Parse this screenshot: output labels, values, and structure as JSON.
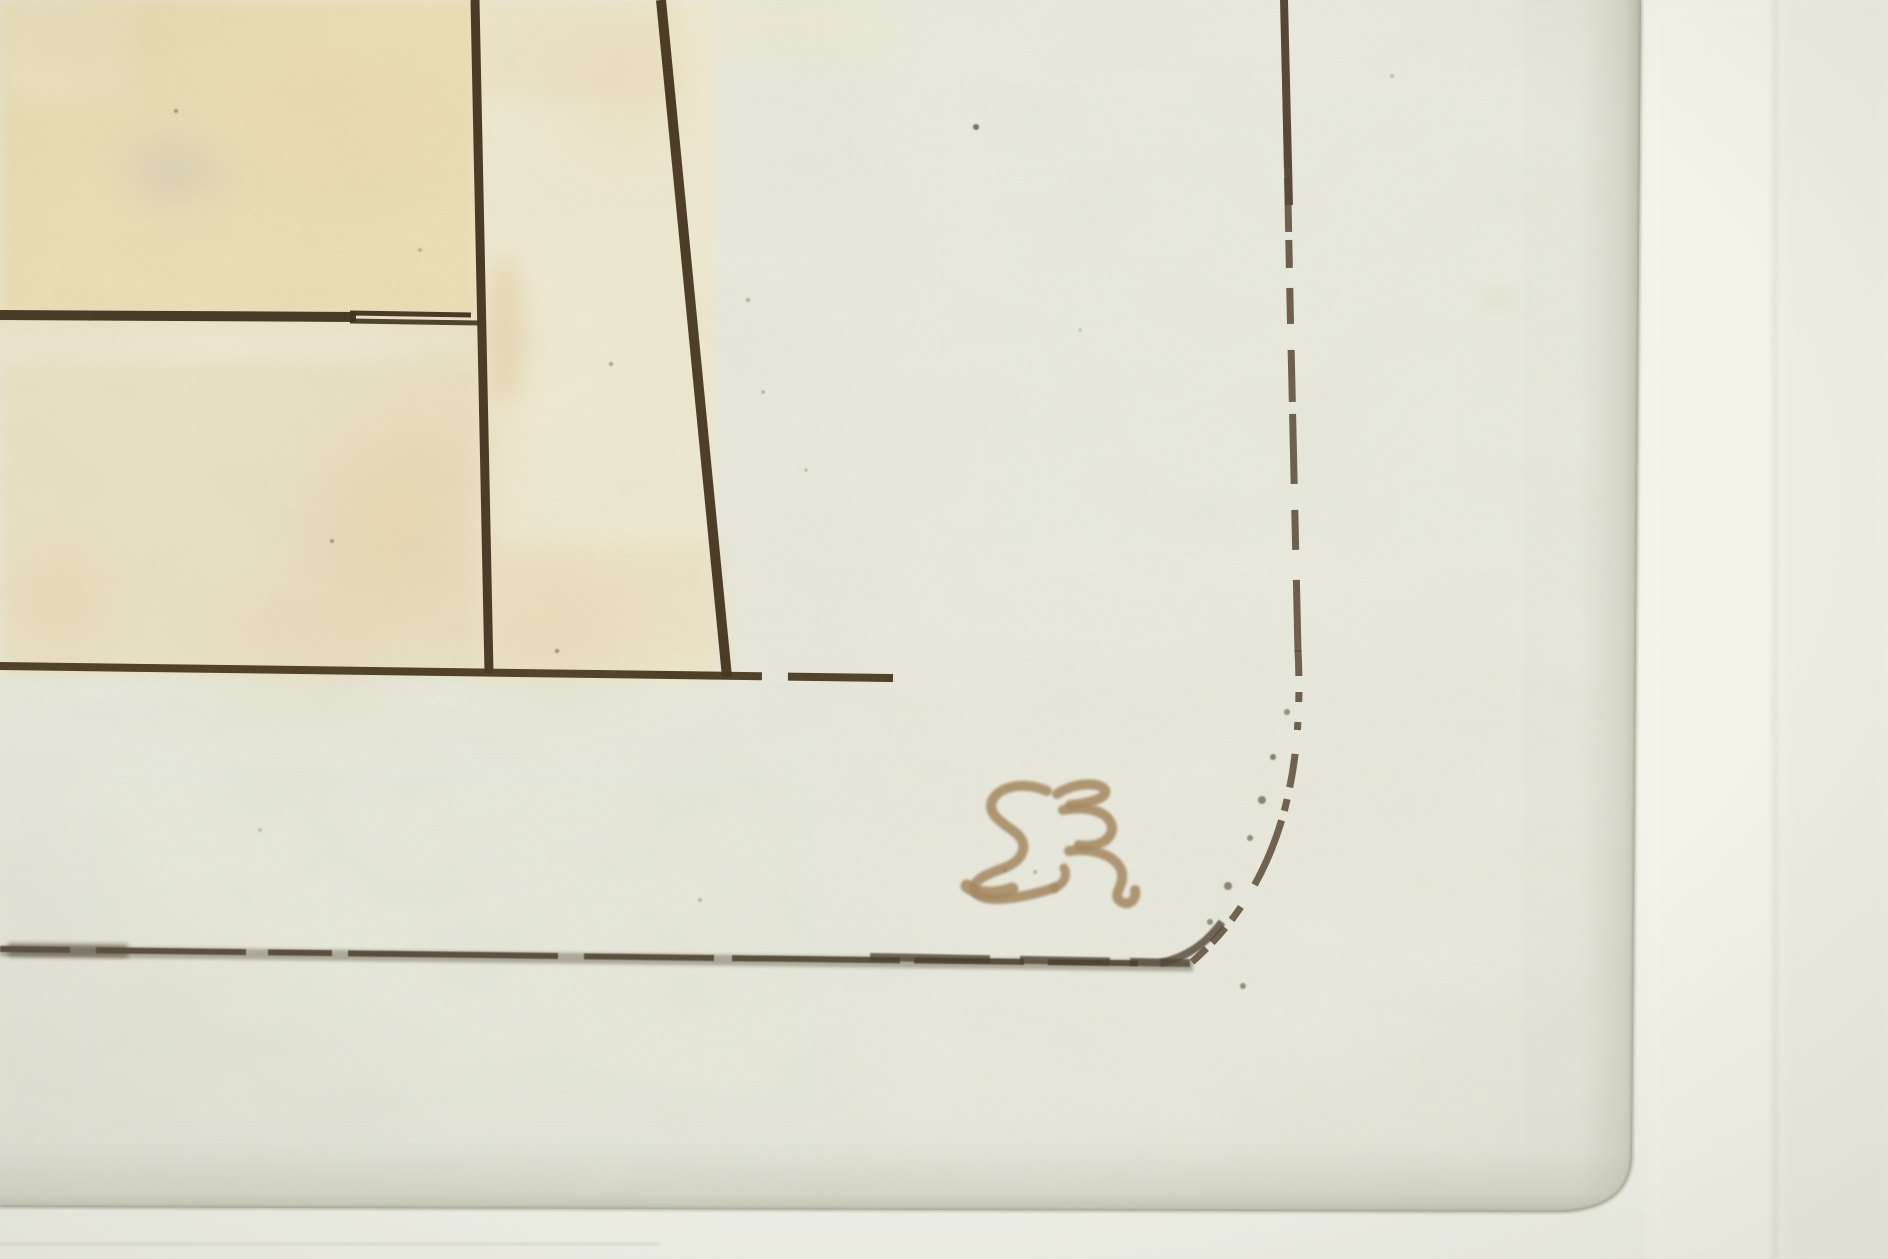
{
  "meta": {
    "scene": "close-up photograph of the lower-right corner of an etching on wove paper, window-matted"
  },
  "theme": {
    "paper": "#e9eadd",
    "mat": "#f3f2e9",
    "ink": "#32230f",
    "border-ink": "#4f3c27",
    "sepia": "#a28257",
    "beige": "#eddfb2"
  },
  "inscription": {
    "reading": "SƐ",
    "appearance": "hand-written sepia plate number printed in reverse (resembles mirrored 35/38)",
    "color": "#a28257",
    "strokes": [
      {
        "d": "M 1047 791 C 1024 781 999 786 992 801 C 987 815 1003 823 1016 833 C 1030 845 1023 861 1004 868 C 984 875 967 883 977 894 C 987 903 1020 899 1054 888",
        "width": 10
      },
      {
        "d": "M 967 886 C 978 895 996 895 1012 889",
        "width": 13
      },
      {
        "d": "M 1054 888 C 1064 884 1068 876 1064 868",
        "width": 9
      },
      {
        "d": "M 1057 794 C 1073 783 1100 781 1105 790 C 1108 798 1090 803 1070 805",
        "width": 10
      },
      {
        "d": "M 1063 810 C 1090 805 1110 813 1112 827 C 1113 840 1097 848 1079 845",
        "width": 10
      },
      {
        "d": "M 1069 851 C 1097 847 1119 858 1122 873 C 1124 886 1113 893 1119 900 C 1126 907 1137 902 1135 890",
        "width": 10
      }
    ]
  },
  "artwork": {
    "canvas": {
      "width": 1888,
      "height": 1259
    },
    "sheet_outline": "M 0 0 L 1641 0 L 1632 1158 Q 1629 1209 1561 1212 L 0 1207 Z",
    "sheet_edge_path": "M 1641 0 L 1632 1158 Q 1629 1209 1561 1212 L 0 1207",
    "washes": [
      {
        "name": "wash-left-top",
        "x": 0,
        "y": 0,
        "w": 484,
        "h": 320,
        "fill": "#eddfb2",
        "opacity": 0.95,
        "blur": 5
      },
      {
        "name": "wash-left-bottom",
        "x": 0,
        "y": 318,
        "w": 490,
        "h": 358,
        "fill": "#ebe2c2",
        "opacity": 0.9,
        "blur": 5
      },
      {
        "name": "wash-mid-column",
        "x": 476,
        "y": 0,
        "w": 238,
        "h": 678,
        "fill": "#f1ead0",
        "opacity": 0.85,
        "blur": 5
      },
      {
        "name": "wash-mid-top",
        "x": 478,
        "y": 0,
        "w": 204,
        "h": 96,
        "fill": "#ecdfb9",
        "opacity": 0.5,
        "blur": 10
      },
      {
        "name": "wash-mid-bottom",
        "x": 484,
        "y": 544,
        "w": 240,
        "h": 132,
        "fill": "#ecdfbc",
        "opacity": 0.55,
        "blur": 10
      },
      {
        "name": "wash-right-of-v2",
        "x": 712,
        "y": 0,
        "w": 182,
        "h": 60,
        "fill": "#efe9cf",
        "opacity": 0.45,
        "blur": 12
      },
      {
        "name": "wash-corner-light",
        "x": 0,
        "y": 0,
        "w": 130,
        "h": 100,
        "fill": "#f3ecd3",
        "opacity": 0.5,
        "blur": 14
      },
      {
        "name": "wash-below-h1-light",
        "x": 0,
        "y": 326,
        "w": 478,
        "h": 38,
        "fill": "#f1ecd8",
        "opacity": 0.5,
        "blur": 8
      },
      {
        "name": "tone-lower-left",
        "x": 0,
        "y": 690,
        "w": 900,
        "h": 500,
        "fill": "#e5e8da",
        "opacity": 0.4,
        "blur": 40
      },
      {
        "name": "tone-upper-right",
        "x": 900,
        "y": 0,
        "w": 720,
        "h": 640,
        "fill": "#eeeee3",
        "opacity": 0.35,
        "blur": 40
      }
    ],
    "stains": [
      {
        "cx": 95,
        "cy": 45,
        "rx": 75,
        "ry": 32,
        "fill": "#e7cf9a",
        "opacity": 0.4
      },
      {
        "cx": 335,
        "cy": 125,
        "rx": 95,
        "ry": 55,
        "fill": "#e7cf9a",
        "opacity": 0.3
      },
      {
        "cx": 395,
        "cy": 525,
        "rx": 75,
        "ry": 95,
        "fill": "#e7cf9a",
        "opacity": 0.45
      },
      {
        "cx": 305,
        "cy": 645,
        "rx": 95,
        "ry": 40,
        "fill": "#e7cf9a",
        "opacity": 0.4
      },
      {
        "cx": 505,
        "cy": 330,
        "rx": 20,
        "ry": 75,
        "fill": "#e4c894",
        "opacity": 0.45
      },
      {
        "cx": 625,
        "cy": 105,
        "rx": 65,
        "ry": 40,
        "fill": "#e7cf9a",
        "opacity": 0.28
      },
      {
        "cx": 545,
        "cy": 625,
        "rx": 85,
        "ry": 40,
        "fill": "#e7cf9a",
        "opacity": 0.38
      },
      {
        "cx": 450,
        "cy": 420,
        "rx": 60,
        "ry": 85,
        "fill": "#ebdaae",
        "opacity": 0.3
      },
      {
        "cx": 172,
        "cy": 170,
        "rx": 48,
        "ry": 28,
        "fill": "#c9c5b0",
        "opacity": 0.55
      },
      {
        "cx": 60,
        "cy": 600,
        "rx": 50,
        "ry": 60,
        "fill": "#e7cf9a",
        "opacity": 0.3
      },
      {
        "cx": 1500,
        "cy": 300,
        "rx": 18,
        "ry": 10,
        "fill": "#e0cfa0",
        "opacity": 0.25
      }
    ],
    "strokes": [
      {
        "name": "line-h1-main",
        "d": "M 0 315 L 356 317",
        "width": 10,
        "color": "#32230f",
        "opacity": 0.95
      },
      {
        "name": "line-h1-upper",
        "d": "M 350 313 L 471 315",
        "width": 5,
        "color": "#32230f",
        "opacity": 0.95
      },
      {
        "name": "line-h1-lower",
        "d": "M 350 321 L 479 323",
        "width": 5,
        "color": "#32230f",
        "opacity": 0.9
      },
      {
        "name": "line-v1",
        "d": "M 475 0 L 489 673",
        "width": 9,
        "color": "#35240f",
        "opacity": 0.95
      },
      {
        "name": "line-v2",
        "d": "M 661 0 L 727 677",
        "width": 10,
        "color": "#38260f",
        "opacity": 0.95
      },
      {
        "name": "line-h2",
        "d": "M 0 666 L 893 678",
        "width": 8,
        "color": "#3e2b11",
        "opacity": 0.95,
        "dash": "762 26 120"
      },
      {
        "name": "borderline-right-top",
        "d": "M 1284 0 L 1289 205",
        "width": 8,
        "color": "#41301c",
        "opacity": 0.9
      },
      {
        "name": "borderline-right",
        "d": "M 1284 0 L 1290 300 L 1298 652",
        "width": 7,
        "color": "#4f3c27",
        "opacity": 0.85,
        "dash": "168 10 54 8 28 20 36 26 52 12 70 26 40 30 90"
      },
      {
        "name": "borderline-corner-arc",
        "d": "M 1298 650 C 1304 770 1283 882 1192 962",
        "width": 7,
        "color": "#503e29",
        "opacity": 0.85,
        "dash": "26 16 10 20 8 24 34 12 12 10 70"
      },
      {
        "name": "borderline-bottom-soft",
        "d": "M 0 951 L 1193 966",
        "width": 11,
        "color": "#6e6452",
        "opacity": 0.5,
        "blur": 1.5
      },
      {
        "name": "borderline-bottom-dark",
        "d": "M 0 949 L 1193 964",
        "width": 6,
        "color": "#453a28",
        "opacity": 0.9,
        "dash": "70 26 150 22 64 16 210 26 130 18 168 14 110 24 90",
        "blur": 0.5
      },
      {
        "name": "borderline-bottom-dark2",
        "d": "M 870 957 L 1190 963",
        "width": 8,
        "color": "#3c3222",
        "opacity": 0.75,
        "dash": "120 30 90 20 80",
        "blur": 0.8
      },
      {
        "name": "borderline-bottom-feather",
        "d": "M 8 950 L 128 951",
        "width": 14,
        "color": "#504633",
        "opacity": 0.55,
        "blur": 2.5
      },
      {
        "name": "corner-turn",
        "d": "M 1160 963 C 1185 958 1205 945 1222 922",
        "width": 8,
        "color": "#46382a",
        "opacity": 0.8,
        "blur": 0.8
      }
    ],
    "specks": [
      [
        976,
        127,
        3,
        "#4e3e2a",
        0.75
      ],
      [
        90,
        318,
        2.5,
        "#3f3321",
        0.6
      ],
      [
        1243,
        986,
        3,
        "#55452e",
        0.6
      ],
      [
        557,
        651,
        2,
        "#4e3e2a",
        0.55
      ],
      [
        611,
        364,
        2,
        "#4e3e2a",
        0.45
      ],
      [
        332,
        541,
        2,
        "#5a4a30",
        0.5
      ],
      [
        748,
        300,
        2,
        "#7a6243",
        0.5
      ],
      [
        763,
        392,
        1.8,
        "#7a6243",
        0.45
      ],
      [
        806,
        470,
        1.8,
        "#7a6243",
        0.4
      ],
      [
        176,
        111,
        2,
        "#4e3e2a",
        0.5
      ],
      [
        1392,
        76,
        2,
        "#6b5a40",
        0.35
      ],
      [
        420,
        250,
        1.8,
        "#5e4c34",
        0.4
      ],
      [
        700,
        900,
        2,
        "#5e5240",
        0.35
      ],
      [
        260,
        830,
        2,
        "#5e5240",
        0.3
      ],
      [
        1080,
        330,
        1.8,
        "#6e5c42",
        0.3
      ],
      [
        1273,
        757,
        3,
        "#55422c",
        0.7
      ],
      [
        1262,
        800,
        4,
        "#55422c",
        0.65
      ],
      [
        1250,
        838,
        3,
        "#55422c",
        0.6
      ],
      [
        1228,
        886,
        4,
        "#55422c",
        0.65
      ],
      [
        1210,
        922,
        3,
        "#55422c",
        0.6
      ],
      [
        1287,
        712,
        3,
        "#55422c",
        0.6
      ],
      [
        1005,
        870,
        2,
        "#8d7350",
        0.5
      ],
      [
        1035,
        872,
        2,
        "#8d7350",
        0.45
      ]
    ],
    "mat": {
      "bands": [
        {
          "name": "mat-bright-core",
          "x": 1646,
          "w": 140,
          "fill": "#f7f6ed",
          "opacity": 0.7,
          "blur": 6
        },
        {
          "name": "mat-seam",
          "x": 1772,
          "w": 6,
          "fill": "#c9c7b4",
          "opacity": 0.35,
          "blur": 2
        },
        {
          "name": "mat-right-zone",
          "x": 1778,
          "w": 110,
          "fill": "#edece1",
          "opacity": 0.6,
          "blur": 4
        },
        {
          "name": "mat-bottom-left-tone",
          "x": 0,
          "y": 1212,
          "w": 1645,
          "h": 47,
          "fill": "#eff0e7",
          "opacity": 0.75
        },
        {
          "name": "mat-bottom-seam",
          "x": 0,
          "y": 1243,
          "w": 660,
          "h": 2,
          "fill": "#aaa896",
          "opacity": 0.3,
          "blur": 1
        }
      ]
    }
  }
}
